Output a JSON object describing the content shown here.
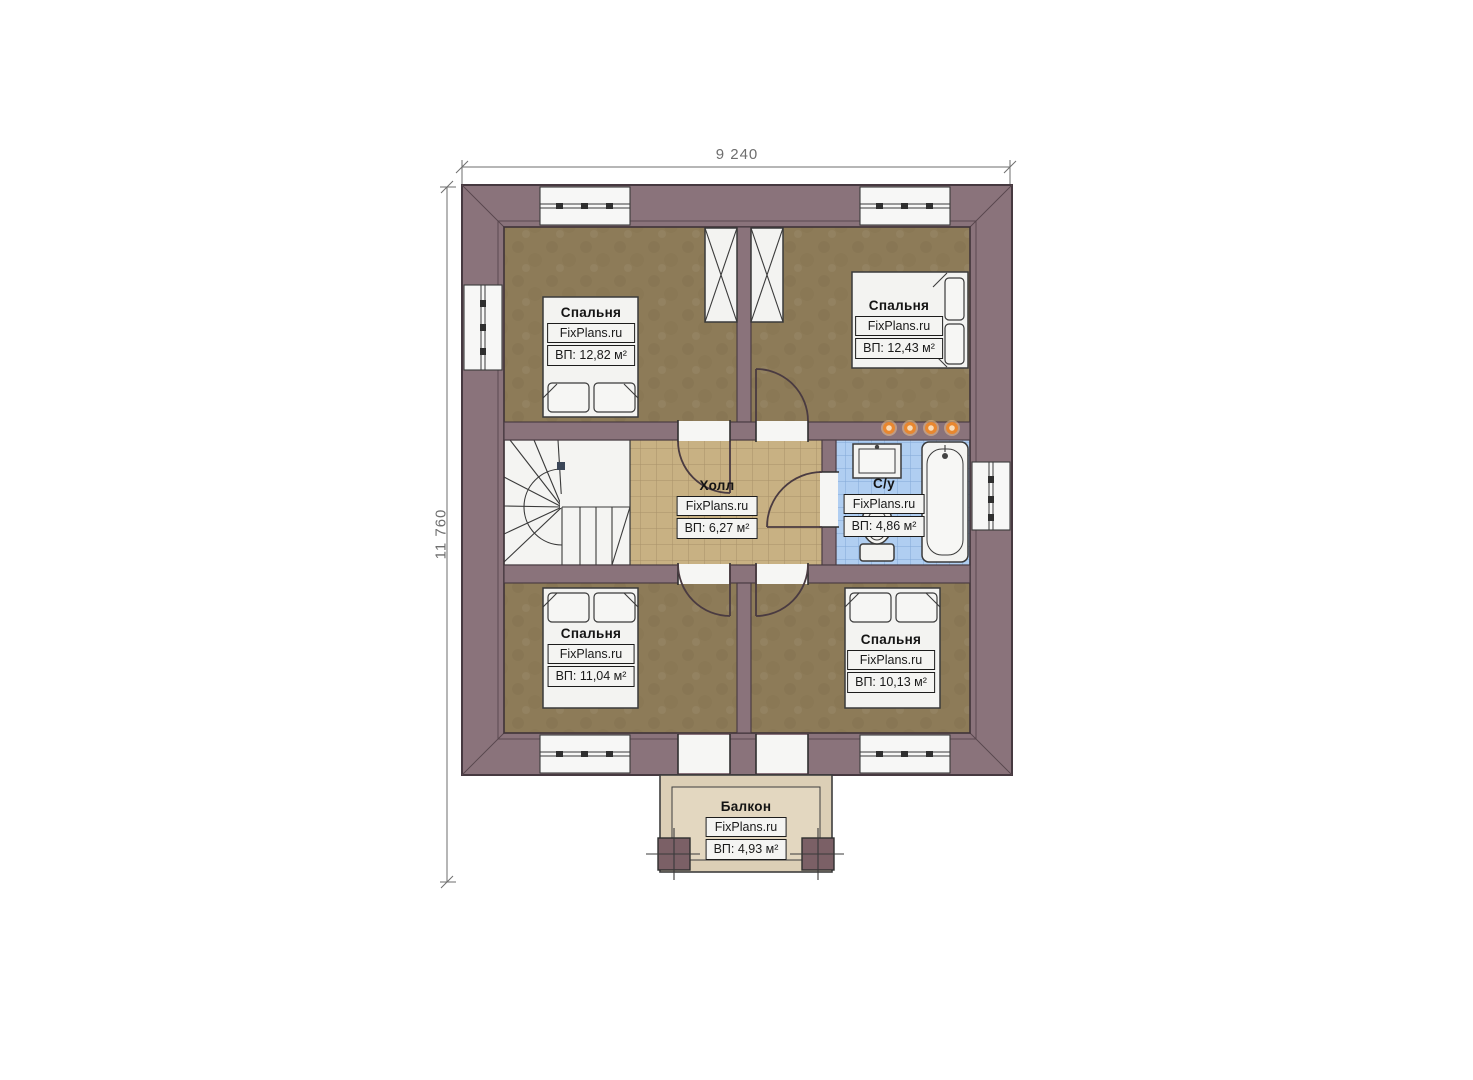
{
  "plan": {
    "brand": "FixPlans.ru",
    "dimensions": {
      "width_label": "9 240",
      "height_label": "11 760"
    },
    "rooms": [
      {
        "id": "bedroom-top-left",
        "name": "Спальня",
        "brand": "FixPlans.ru",
        "area": "ВП: 12,82 м²"
      },
      {
        "id": "bedroom-top-right",
        "name": "Спальня",
        "brand": "FixPlans.ru",
        "area": "ВП: 12,43 м²"
      },
      {
        "id": "hall",
        "name": "Холл",
        "brand": "FixPlans.ru",
        "area": "ВП: 6,27 м²"
      },
      {
        "id": "bathroom",
        "name": "С/у",
        "brand": "FixPlans.ru",
        "area": "ВП: 4,86 м²"
      },
      {
        "id": "bedroom-bottom-left",
        "name": "Спальня",
        "brand": "FixPlans.ru",
        "area": "ВП: 11,04 м²"
      },
      {
        "id": "bedroom-bottom-right",
        "name": "Спальня",
        "brand": "FixPlans.ru",
        "area": "ВП: 10,13 м²"
      },
      {
        "id": "balcony",
        "name": "Балкон",
        "brand": "FixPlans.ru",
        "area": "ВП: 4,93 м²"
      }
    ],
    "colors": {
      "wall": "#8a737b",
      "bedroom_floor": "#8d7b58",
      "hall_floor": "#c8b183",
      "hall_grid": "#a8916a",
      "bathroom_floor": "#b0cef1",
      "bathroom_grid": "#82a8d6",
      "balcony_floor": "#dccfb6",
      "balcony_floor_inner": "#e3d7c0",
      "post": "#7b6066",
      "light_orange": "#e8872f",
      "light_glow": "#f6c68e",
      "dimension": "#6e6e6e"
    }
  }
}
